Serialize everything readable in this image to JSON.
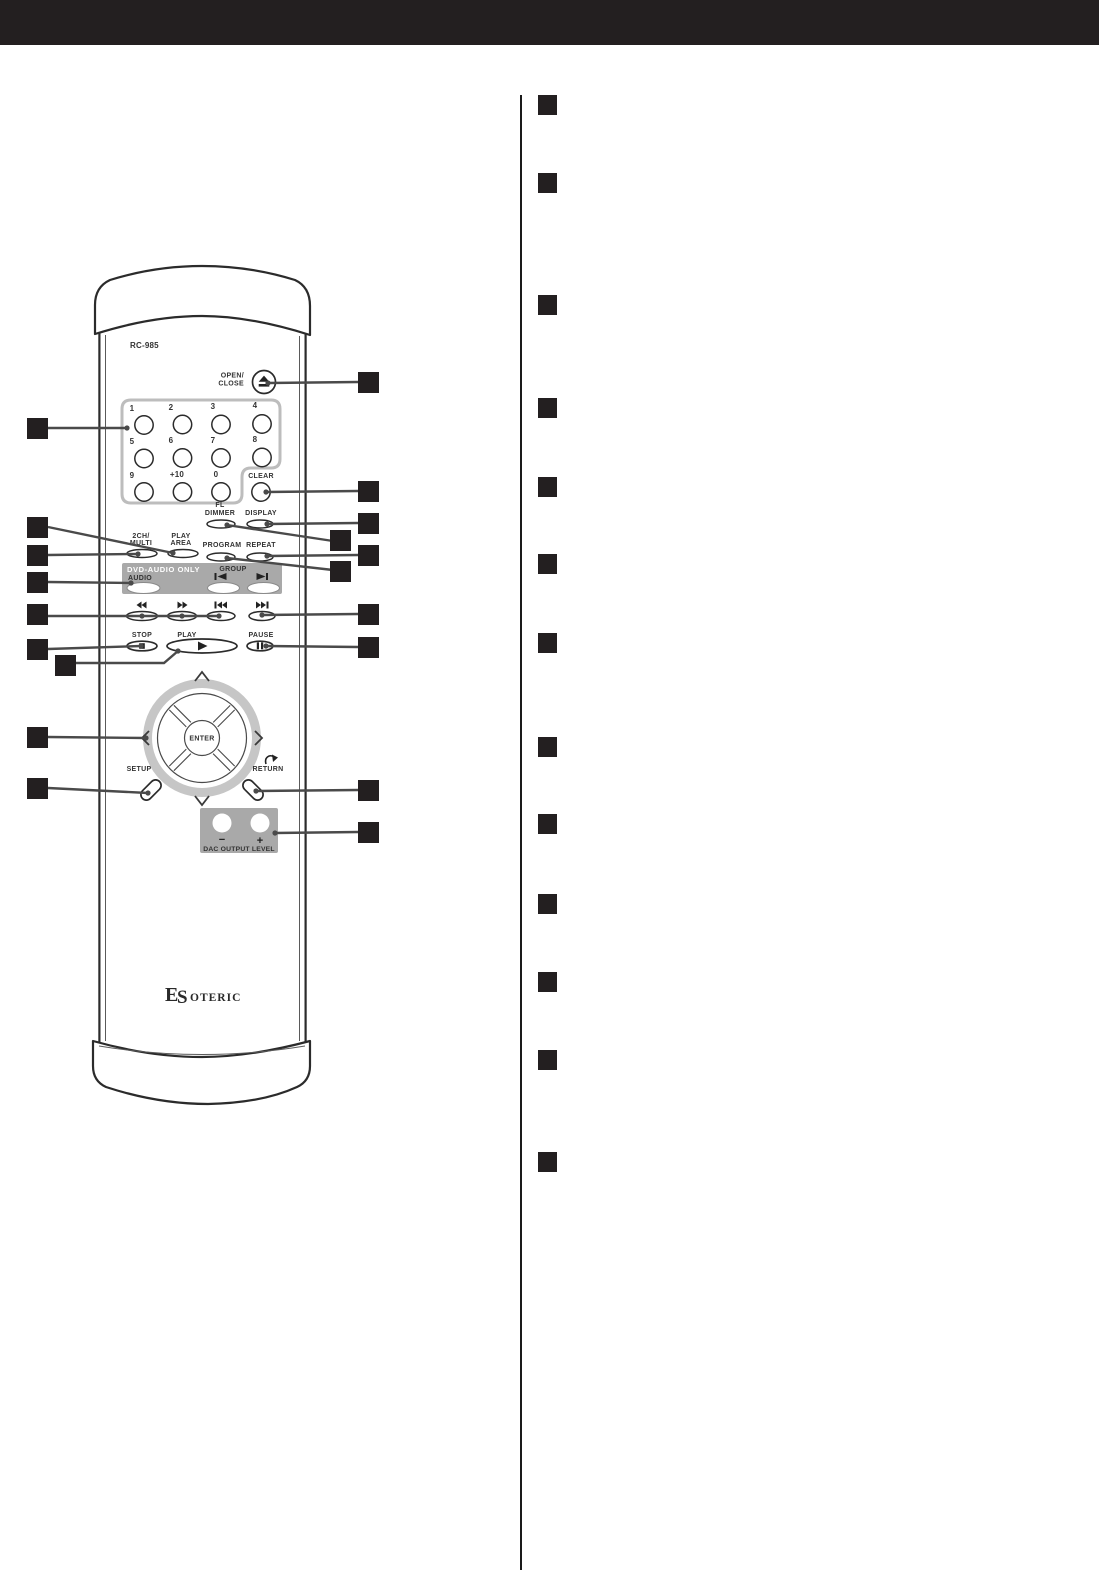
{
  "colors": {
    "ink": "#231f20",
    "panel": "#a9a9a9",
    "line": "#4a4a4a",
    "outline": "#2b2b2b"
  },
  "remote": {
    "model": "RC-985",
    "logo_parts": [
      "E",
      "S",
      "OTERIC"
    ],
    "open_close": {
      "line1": "OPEN/",
      "line2": "CLOSE"
    },
    "keypad": {
      "digits": [
        "1",
        "2",
        "3",
        "4",
        "5",
        "6",
        "7",
        "8",
        "9",
        "+10",
        "0"
      ],
      "clear": "CLEAR"
    },
    "buttons": {
      "fl_line1": "FL",
      "fl_line2": "DIMMER",
      "display": "DISPLAY",
      "ch_line1": "2CH/",
      "ch_line2": "MULTI",
      "area_line1": "PLAY",
      "area_line2": "AREA",
      "program": "PROGRAM",
      "repeat": "REPEAT",
      "dvd_audio_panel": "DVD-AUDIO ONLY",
      "group": "GROUP",
      "audio": "AUDIO",
      "stop": "STOP",
      "play": "PLAY",
      "pause": "PAUSE",
      "enter": "ENTER",
      "setup": "SETUP",
      "return": "RETURN",
      "minus": "−",
      "plus": "+",
      "dac": "DAC OUTPUT LEVEL"
    },
    "icons": {
      "eject": "⏏",
      "rewind": "◀◀",
      "fast_forward": "▶▶",
      "skip_back": "|◀◀",
      "skip_forward": "▶▶|",
      "group_back": "|◀",
      "group_forward": "▶|",
      "stop": "■",
      "play": "▶",
      "pause": "❚❚",
      "up": "∧",
      "down": "∨",
      "left": "<",
      "right": ">",
      "return": "↷"
    }
  },
  "right_column": {
    "marker_count": 13
  }
}
